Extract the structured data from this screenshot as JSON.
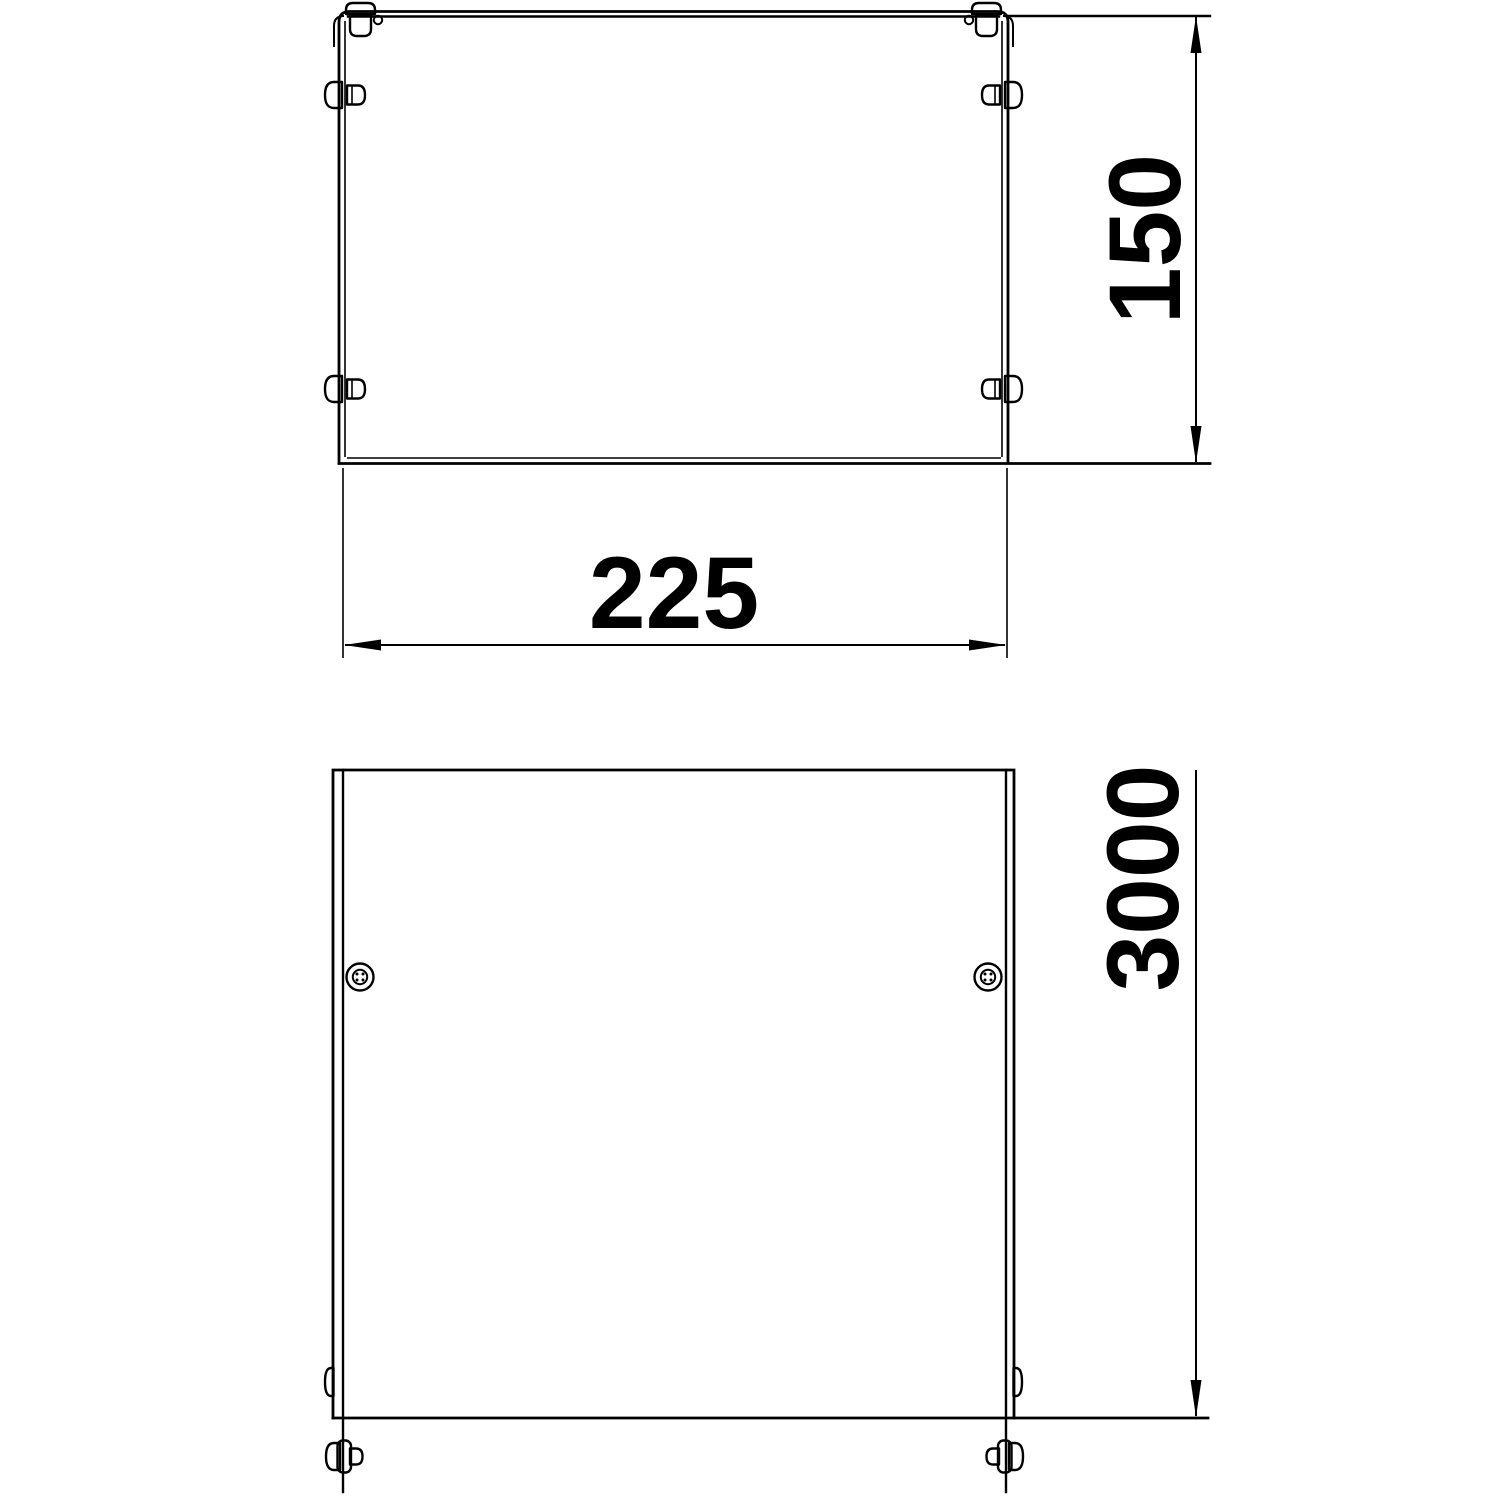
{
  "drawing": {
    "type": "technical-drawing",
    "background_color": "#ffffff",
    "line_color": "#000000",
    "views": {
      "section": {
        "description": "cross-section end view of cable tray cover",
        "height_dimension": "150",
        "width_dimension": "225",
        "icons": [
          "corner-clip-icon",
          "side-clip-icon"
        ]
      },
      "plan": {
        "description": "plan view of tray length",
        "length_dimension": "3000",
        "icons": [
          "screw-head-icon",
          "coupling-clip-icon"
        ]
      }
    }
  }
}
